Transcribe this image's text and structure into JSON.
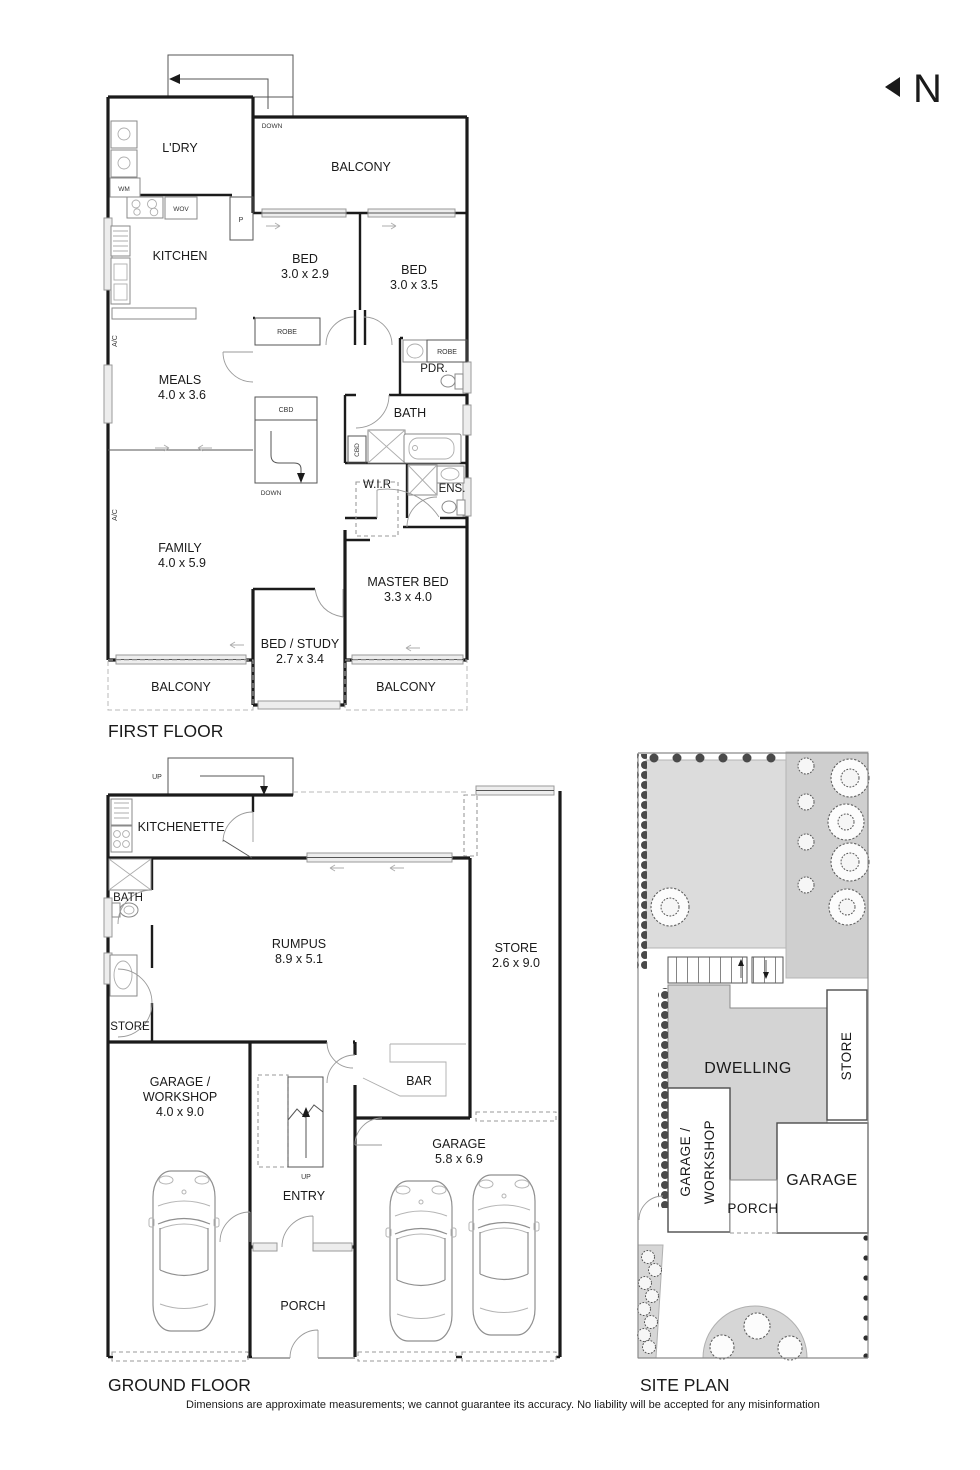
{
  "north": "N",
  "first_floor": {
    "title": "FIRST FLOOR",
    "labels": {
      "ldry": "L'DRY",
      "wm": "WM",
      "wov": "WOV",
      "pantry": "P",
      "kitchen": "KITCHEN",
      "balcony_top": "BALCONY",
      "down_top": "DOWN",
      "bed1": "BED",
      "bed1_dims": "3.0 x 2.9",
      "bed2": "BED",
      "bed2_dims": "3.0 x 3.5",
      "robe1": "ROBE",
      "robe2": "ROBE",
      "meals": "MEALS",
      "meals_dims": "4.0 x 3.6",
      "ac_upper": "A/C",
      "ac_lower": "A/C",
      "cbd_stair": "CBD",
      "cbd_bath": "CBD",
      "down_mid": "DOWN",
      "pdr": "PDR.",
      "bath": "BATH",
      "wir": "W.I.R",
      "ens": "ENS.",
      "family": "FAMILY",
      "family_dims": "4.0 x 5.9",
      "master": "MASTER BED",
      "master_dims": "3.3 x 4.0",
      "bedstudy": "BED / STUDY",
      "bedstudy_dims": "2.7 x 3.4",
      "balcony_left": "BALCONY",
      "balcony_right": "BALCONY"
    }
  },
  "ground_floor": {
    "title": "GROUND FLOOR",
    "labels": {
      "up_top": "UP",
      "up_mid": "UP",
      "kitchenette": "KITCHENETTE",
      "bath": "BATH",
      "store_left": "STORE",
      "rumpus": "RUMPUS",
      "rumpus_dims": "8.9 x 5.1",
      "store_right": "STORE",
      "store_right_dims": "2.6 x 9.0",
      "gw1": "GARAGE /",
      "gw2": "WORKSHOP",
      "gw_dims": "4.0 x 9.0",
      "entry": "ENTRY",
      "bar": "BAR",
      "garage": "GARAGE",
      "garage_dims": "5.8 x 6.9",
      "porch": "PORCH"
    }
  },
  "site_plan": {
    "title": "SITE PLAN",
    "labels": {
      "dwelling": "DWELLING",
      "gw1": "GARAGE /",
      "gw2": "WORKSHOP",
      "store": "STORE",
      "garage": "GARAGE",
      "porch": "PORCH"
    }
  },
  "disclaimer": "Dimensions are approximate measurements; we cannot guarantee its accuracy. No liability will be accepted for any misinformation"
}
